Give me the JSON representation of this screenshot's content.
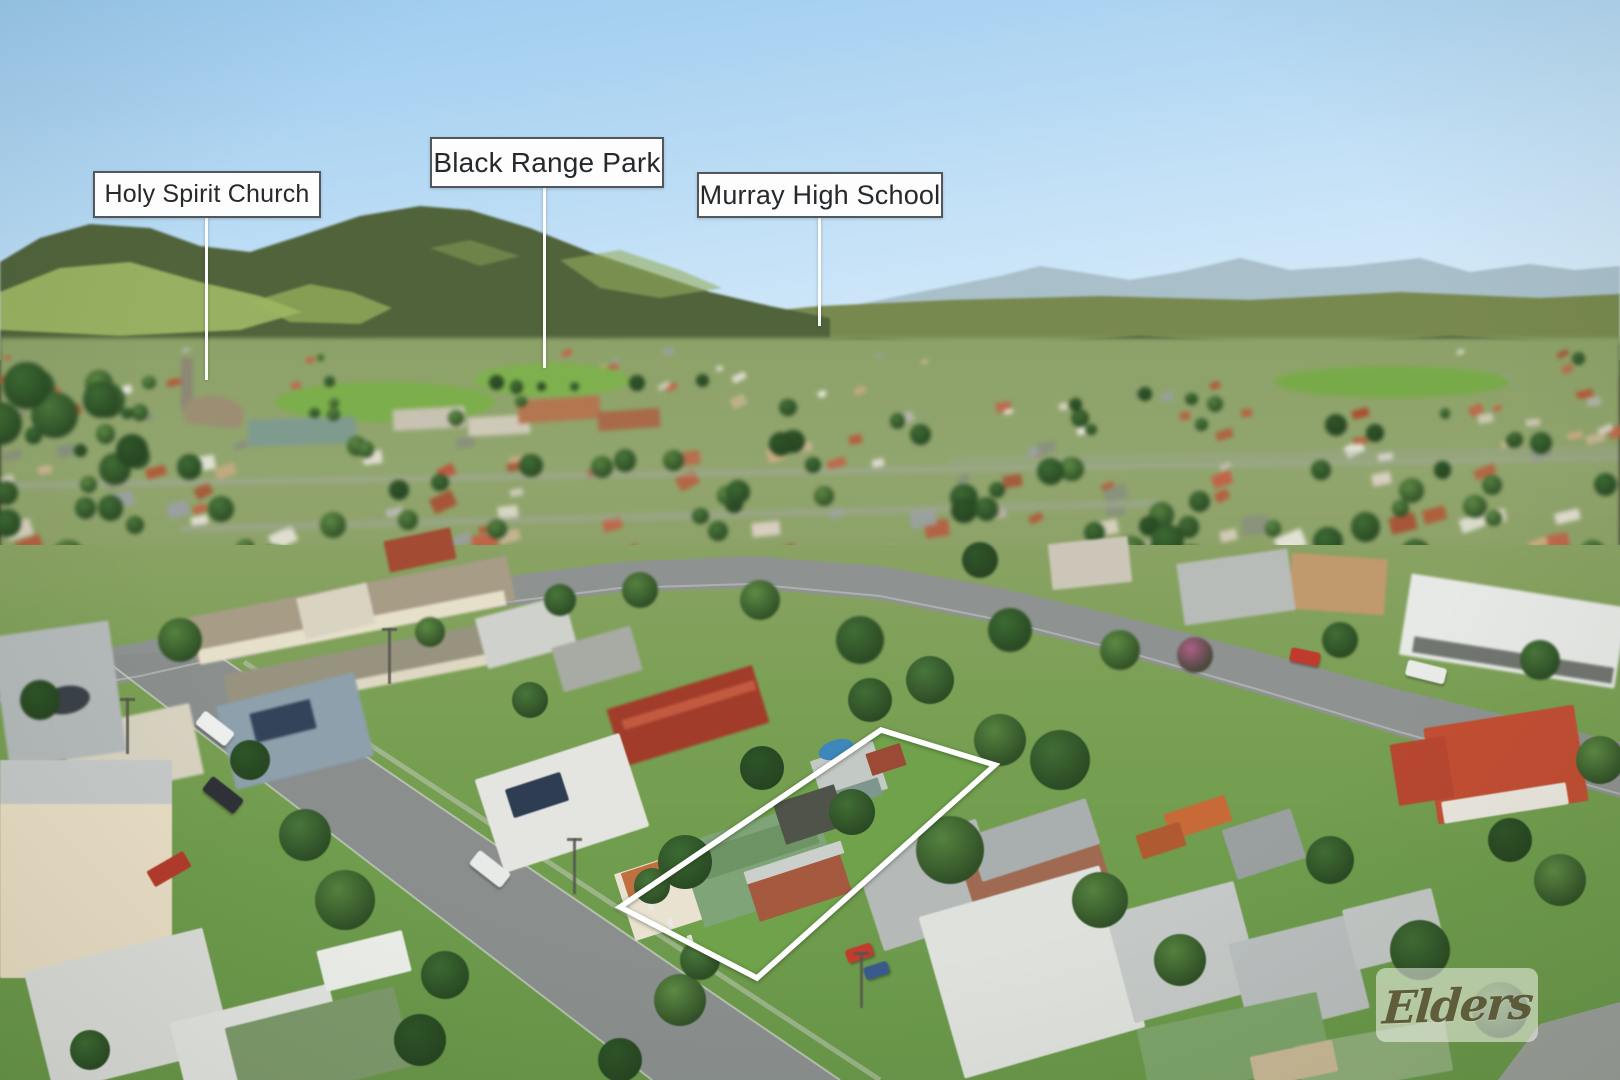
{
  "photo": {
    "type": "aerial-drone-photo-with-property-outline",
    "location_labels": [
      {
        "text": "Holy Spirit Church"
      },
      {
        "text": "Black Range Park"
      },
      {
        "text": "Murray High School"
      }
    ],
    "property_boundary": {
      "color": "#ffffff"
    },
    "watermark": {
      "brand": "Elders",
      "text_color": "#484220"
    },
    "palette": {
      "sky_top": "#9ccaee",
      "sky_horizon": "#ddeefa",
      "hill_dark": "#51633b",
      "hill_grass": "#a4bd69",
      "range_blue": "#a9bfca",
      "label_border": "#51575c",
      "label_text": "#26292c",
      "road": "#8e9391",
      "grass": "#6f9c4d",
      "park_green": "#7cae4b",
      "subject_roof_green": "#7fa477",
      "roof_colors": [
        "#b15a3a",
        "#c06448",
        "#a84e32",
        "#b9593c",
        "#d8cfc0",
        "#e2ddd2",
        "#b8b8b2",
        "#9aa0a0",
        "#c9ab82",
        "#c7b492",
        "#88907e",
        "#e8e6dd"
      ],
      "tree_colors": [
        "#2f5529",
        "#3c6a33",
        "#49763b",
        "#55823f",
        "#416d35",
        "#5d8a44"
      ]
    }
  }
}
